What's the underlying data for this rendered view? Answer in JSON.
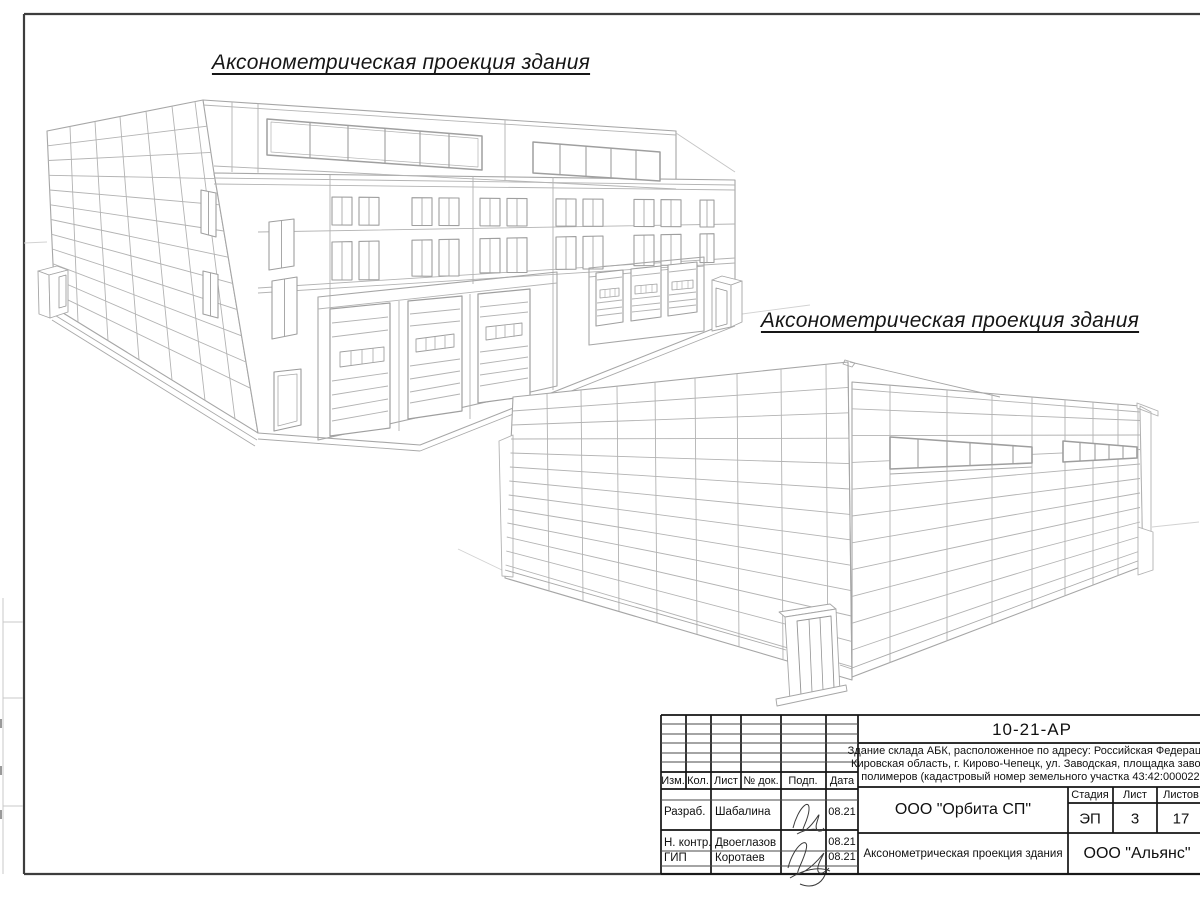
{
  "drawing_titles": {
    "view1": "Аксонометрическая проекция здания",
    "view2": "Аксонометрическая проекция здания"
  },
  "title_block": {
    "document_code": "10-21-АР",
    "description_lines": [
      "Здание склада АБК, расположенное по адресу: Российская Федерация,",
      "Кировская область, г. Кирово-Чепецк, ул. Заводская, площадка завода",
      "полимеров (кадастровый номер земельного участка 43:42:000022:"
    ],
    "revision_header": {
      "izm": "Изм.",
      "kol": "Кол.",
      "list": "Лист",
      "ndok": "№ док.",
      "podp": "Подп.",
      "data": "Дата"
    },
    "signature_rows": [
      {
        "role": "Разраб.",
        "name": "Шабалина",
        "date": "08.21"
      },
      {
        "role": "Н. контр.",
        "name": "Двоеглазов",
        "date": "08.21"
      },
      {
        "role": "ГИП",
        "name": "Коротаев",
        "date": "08.21"
      }
    ],
    "designer_org": "ООО \"Орбита СП\"",
    "stage_header": {
      "stage": "Стадия",
      "sheet": "Лист",
      "sheets": "Листов"
    },
    "stage_values": {
      "stage": "ЭП",
      "sheet": "3",
      "sheets": "17"
    },
    "sheet_title": "Аксонометрическая проекция здания",
    "client_org": "ООО \"Альянс\""
  }
}
